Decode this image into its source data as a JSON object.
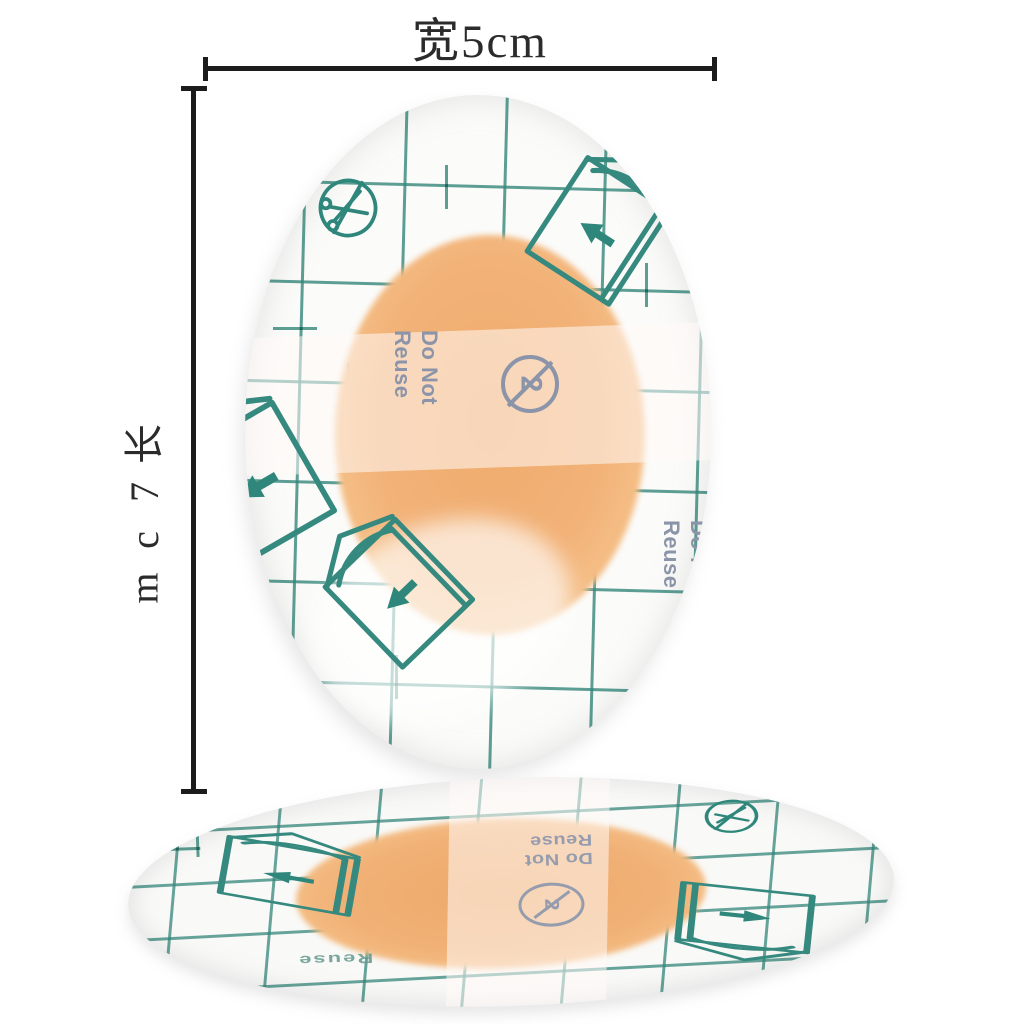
{
  "photo": {
    "measure": {
      "width_label": "宽5cm",
      "width_value": "5cm",
      "length_value": "7cm",
      "length_chars": [
        "长",
        "7",
        "c",
        "m"
      ]
    },
    "print": {
      "do_not_line1": "Do Not",
      "do_not_line2": "Reuse",
      "reuse_partial": "Reuse",
      "no_reuse_symbol": "2"
    },
    "icons": {
      "no_scissors": "no-scissors-icon",
      "peel_corner": "peel-corner-icon",
      "no_reuse": "no-reuse-icon"
    },
    "colors": {
      "grid_teal": "#35897e",
      "label_slate": "#8b94a8",
      "pad_orange": "#f2b278",
      "measure_black": "#1c1c1c"
    }
  }
}
